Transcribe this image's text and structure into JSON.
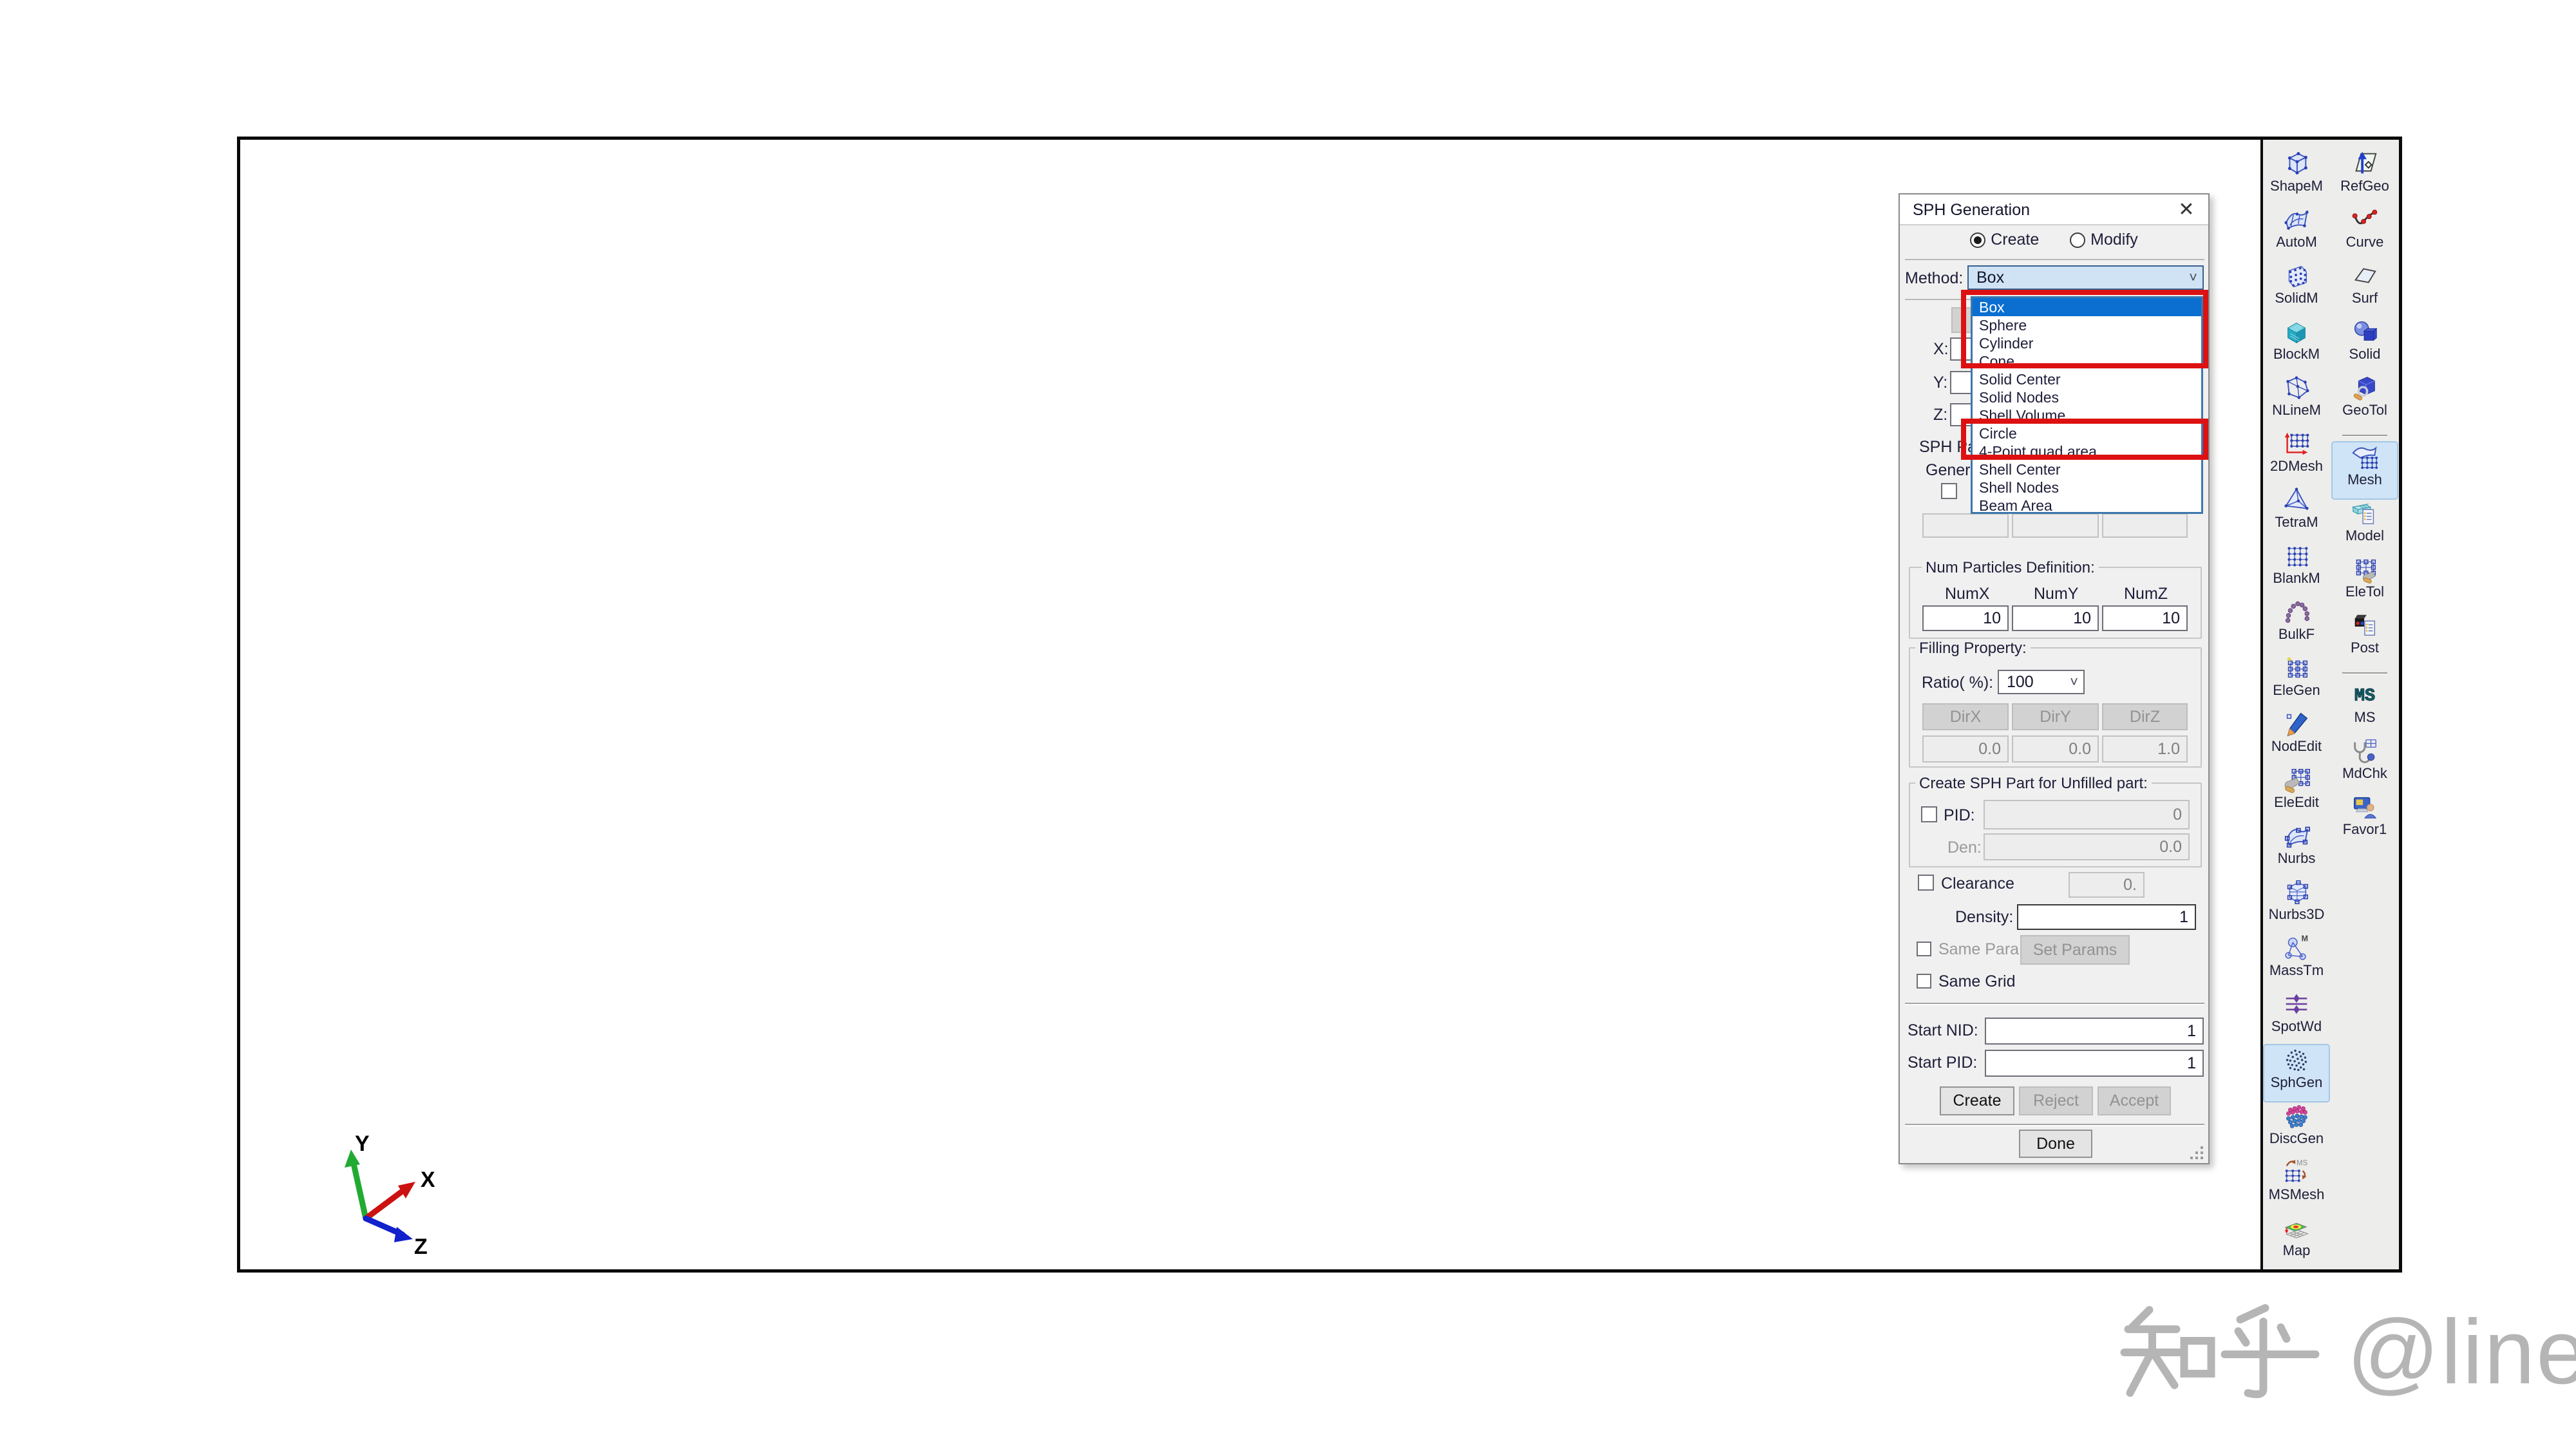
{
  "colors": {
    "accent_blue": "#0a6fd1",
    "annotation_red": "#dd1111",
    "selected_cell": "#cfe4f6",
    "axis_x": "#cc1111",
    "axis_y": "#22aa33",
    "axis_z": "#1122cc"
  },
  "dialog": {
    "title": "SPH Generation",
    "close_icon": "close-icon",
    "mode": {
      "create_label": "Create",
      "modify_label": "Modify",
      "selected": "Create"
    },
    "method_label": "Method:",
    "method_value": "Box",
    "dropdown": {
      "items": [
        {
          "label": "Box",
          "selected": true
        },
        {
          "label": "Sphere",
          "selected": false
        },
        {
          "label": "Cylinder",
          "selected": false
        },
        {
          "label": "Cone",
          "selected": false
        },
        {
          "label": "Solid Center",
          "selected": false
        },
        {
          "label": "Solid Nodes",
          "selected": false
        },
        {
          "label": "Shell Volume",
          "selected": false
        },
        {
          "label": "Circle",
          "selected": false
        },
        {
          "label": "4-Point quad area",
          "selected": false
        },
        {
          "label": "Shell Center",
          "selected": false
        },
        {
          "label": "Shell Nodes",
          "selected": false
        },
        {
          "label": "Beam Area",
          "selected": false
        }
      ],
      "annotations": {
        "red_box_1_items": [
          "Box",
          "Sphere",
          "Cylinder",
          "Cone"
        ],
        "red_box_2_items": [
          "Circle",
          "4-Point quad area"
        ]
      }
    },
    "coord_labels": [
      "X:",
      "Y:",
      "Z:"
    ],
    "clipped_sph_part_label": "SPH Pa",
    "clipped_general_label": "Gener",
    "num_particles": {
      "title": "Num Particles Definition:",
      "cols": [
        "NumX",
        "NumY",
        "NumZ"
      ],
      "values": [
        "10",
        "10",
        "10"
      ]
    },
    "filling": {
      "title": "Filling Property:",
      "ratio_label": "Ratio( %):",
      "ratio_value": "100",
      "dir_buttons": [
        "DirX",
        "DirY",
        "DirZ"
      ],
      "dir_values": [
        "0.0",
        "0.0",
        "1.0"
      ]
    },
    "unfilled": {
      "title": "Create SPH Part for Unfilled part:",
      "pid_label": "PID:",
      "pid_value": "0",
      "den_label": "Den:",
      "den_value": "0.0"
    },
    "clearance_label": "Clearance",
    "clearance_value": "0.",
    "density_label": "Density:",
    "density_value": "1",
    "same_para_label": "Same Para",
    "set_params_label": "Set Params",
    "same_grid_label": "Same Grid",
    "start_nid_label": "Start NID:",
    "start_nid_value": "1",
    "start_pid_label": "Start PID:",
    "start_pid_value": "1",
    "buttons": {
      "create": "Create",
      "reject": "Reject",
      "accept": "Accept",
      "done": "Done"
    }
  },
  "toolbar": {
    "column1": [
      {
        "label": "ShapeM",
        "icon": "shapem"
      },
      {
        "label": "AutoM",
        "icon": "autom"
      },
      {
        "label": "SolidM",
        "icon": "solidm"
      },
      {
        "label": "BlockM",
        "icon": "blockm"
      },
      {
        "label": "NLineM",
        "icon": "nlinem"
      },
      {
        "label": "2DMesh",
        "icon": "mesh2d"
      },
      {
        "label": "TetraM",
        "icon": "tetram"
      },
      {
        "label": "BlankM",
        "icon": "blankm"
      },
      {
        "label": "BulkF",
        "icon": "bulkf"
      },
      {
        "label": "EleGen",
        "icon": "elegen"
      },
      {
        "label": "NodEdit",
        "icon": "nodedit"
      },
      {
        "label": "EleEdit",
        "icon": "eleedit"
      },
      {
        "label": "Nurbs",
        "icon": "nurbs"
      },
      {
        "label": "Nurbs3D",
        "icon": "nurbs3d"
      },
      {
        "label": "MassTm",
        "icon": "masstm"
      },
      {
        "label": "SpotWd",
        "icon": "spotwd"
      },
      {
        "label": "SphGen",
        "icon": "sphgen",
        "selected": true
      },
      {
        "label": "DiscGen",
        "icon": "discgen"
      },
      {
        "label": "MSMesh",
        "icon": "msmesh"
      },
      {
        "label": "Map",
        "icon": "map"
      }
    ],
    "column2": [
      {
        "label": "RefGeo",
        "icon": "refgeo"
      },
      {
        "label": "Curve",
        "icon": "curve"
      },
      {
        "label": "Surf",
        "icon": "surf"
      },
      {
        "label": "Solid",
        "icon": "solid"
      },
      {
        "label": "GeoTol",
        "icon": "geotol"
      },
      {
        "separator": true
      },
      {
        "label": "Mesh",
        "icon": "mesh",
        "selected": true
      },
      {
        "label": "Model",
        "icon": "model"
      },
      {
        "label": "EleTol",
        "icon": "eletol"
      },
      {
        "label": "Post",
        "icon": "post"
      },
      {
        "separator": true
      },
      {
        "label": "MS",
        "icon": "ms"
      },
      {
        "label": "MdChk",
        "icon": "mdchk"
      },
      {
        "label": "Favor1",
        "icon": "favor1"
      }
    ]
  },
  "axis": {
    "x_label": "X",
    "y_label": "Y",
    "z_label": "Z"
  },
  "watermark": {
    "text": "知乎 @line",
    "brand": "知乎",
    "handle": "@line"
  }
}
